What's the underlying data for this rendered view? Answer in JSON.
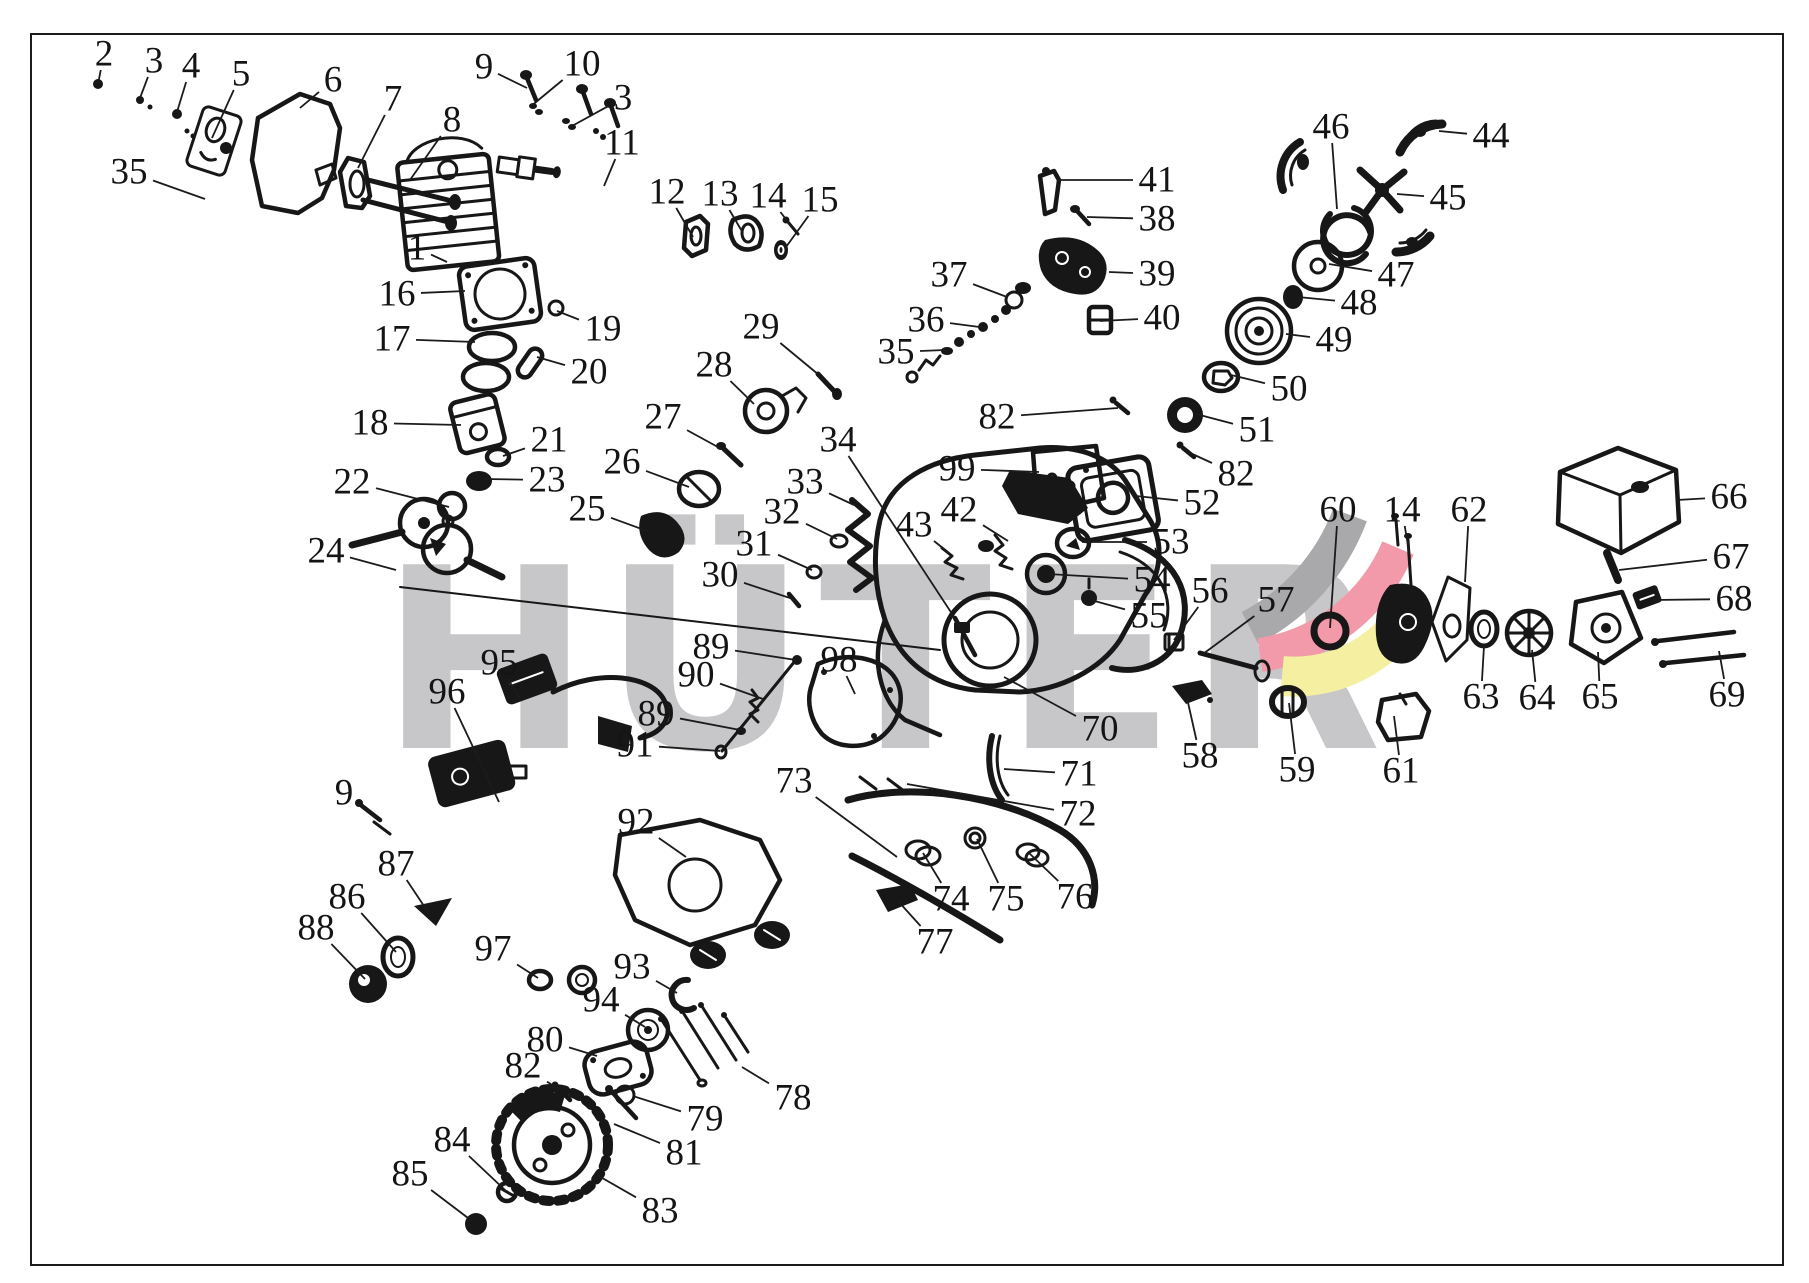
{
  "diagram": {
    "watermark_text": "HÜTER",
    "watermark_color": "#c7c7c9",
    "background": "#ffffff",
    "line_color": "#1b1b1b",
    "label_color": "#141414",
    "logo": {
      "gray": "#a9a9ab",
      "red": "#f29aaa",
      "yellow": "#f5efa2"
    },
    "labels": [
      {
        "n": "2",
        "x": 104,
        "y": 54,
        "tx": 98,
        "ty": 84
      },
      {
        "n": "3",
        "x": 154,
        "y": 61,
        "tx": 140,
        "ty": 98
      },
      {
        "n": "4",
        "x": 191,
        "y": 66,
        "tx": 177,
        "ty": 112
      },
      {
        "n": "5",
        "x": 241,
        "y": 74,
        "tx": 212,
        "ty": 138
      },
      {
        "n": "6",
        "x": 333,
        "y": 80,
        "tx": 300,
        "ty": 108
      },
      {
        "n": "7",
        "x": 393,
        "y": 99,
        "tx": 358,
        "ty": 168
      },
      {
        "n": "8",
        "x": 452,
        "y": 120,
        "tx": 410,
        "ty": 180
      },
      {
        "n": "9",
        "x": 484,
        "y": 67,
        "tx": 527,
        "ty": 88
      },
      {
        "n": "10",
        "x": 582,
        "y": 64,
        "tx": 530,
        "ty": 107
      },
      {
        "n": "3",
        "x": 623,
        "y": 98,
        "tx": 572,
        "ty": 126
      },
      {
        "n": "11",
        "x": 622,
        "y": 143,
        "tx": 604,
        "ty": 186
      },
      {
        "n": "12",
        "x": 667,
        "y": 192,
        "tx": 693,
        "ty": 237
      },
      {
        "n": "13",
        "x": 720,
        "y": 194,
        "tx": 743,
        "ty": 233
      },
      {
        "n": "14",
        "x": 768,
        "y": 196,
        "tx": 792,
        "ty": 227
      },
      {
        "n": "15",
        "x": 820,
        "y": 200,
        "tx": 786,
        "ty": 247
      },
      {
        "n": "1",
        "x": 417,
        "y": 248,
        "tx": 447,
        "ty": 262
      },
      {
        "n": "16",
        "x": 397,
        "y": 294,
        "tx": 465,
        "ty": 291
      },
      {
        "n": "17",
        "x": 392,
        "y": 339,
        "tx": 475,
        "ty": 342
      },
      {
        "n": "19",
        "x": 603,
        "y": 329,
        "tx": 557,
        "ty": 311
      },
      {
        "n": "20",
        "x": 589,
        "y": 372,
        "tx": 537,
        "ty": 357
      },
      {
        "n": "18",
        "x": 370,
        "y": 423,
        "tx": 461,
        "ty": 425
      },
      {
        "n": "21",
        "x": 549,
        "y": 440,
        "tx": 503,
        "ty": 456
      },
      {
        "n": "23",
        "x": 547,
        "y": 480,
        "tx": 485,
        "ty": 479
      },
      {
        "n": "22",
        "x": 352,
        "y": 482,
        "tx": 449,
        "ty": 507
      },
      {
        "n": "24",
        "x": 326,
        "y": 551,
        "tx": 396,
        "ty": 570
      },
      {
        "n": "25",
        "x": 587,
        "y": 509,
        "tx": 647,
        "ty": 531
      },
      {
        "n": "26",
        "x": 622,
        "y": 462,
        "tx": 689,
        "ty": 487
      },
      {
        "n": "27",
        "x": 663,
        "y": 417,
        "tx": 727,
        "ty": 452
      },
      {
        "n": "28",
        "x": 714,
        "y": 365,
        "tx": 754,
        "ty": 404
      },
      {
        "n": "29",
        "x": 761,
        "y": 327,
        "tx": 819,
        "ty": 375
      },
      {
        "n": "34",
        "x": 838,
        "y": 440,
        "tx": 960,
        "ty": 626
      },
      {
        "n": "33",
        "x": 805,
        "y": 482,
        "tx": 854,
        "ty": 505
      },
      {
        "n": "32",
        "x": 782,
        "y": 512,
        "tx": 837,
        "ty": 539
      },
      {
        "n": "31",
        "x": 754,
        "y": 544,
        "tx": 812,
        "ty": 570
      },
      {
        "n": "30",
        "x": 720,
        "y": 575,
        "tx": 793,
        "ty": 599
      },
      {
        "n": "35",
        "x": 129,
        "y": 172,
        "tx": 205,
        "ty": 199
      },
      {
        "n": "35",
        "x": 896,
        "y": 352,
        "tx": 945,
        "ty": 350
      },
      {
        "n": "36",
        "x": 926,
        "y": 320,
        "tx": 987,
        "ty": 328
      },
      {
        "n": "37",
        "x": 949,
        "y": 275,
        "tx": 1007,
        "ty": 297
      },
      {
        "n": "41",
        "x": 1157,
        "y": 180,
        "tx": 1057,
        "ty": 180
      },
      {
        "n": "38",
        "x": 1157,
        "y": 219,
        "tx": 1087,
        "ty": 217
      },
      {
        "n": "39",
        "x": 1157,
        "y": 274,
        "tx": 1109,
        "ty": 272
      },
      {
        "n": "40",
        "x": 1162,
        "y": 318,
        "tx": 1100,
        "ty": 321
      },
      {
        "n": "46",
        "x": 1331,
        "y": 127,
        "tx": 1337,
        "ty": 209
      },
      {
        "n": "44",
        "x": 1491,
        "y": 136,
        "tx": 1439,
        "ty": 131
      },
      {
        "n": "45",
        "x": 1448,
        "y": 198,
        "tx": 1397,
        "ty": 194
      },
      {
        "n": "47",
        "x": 1396,
        "y": 275,
        "tx": 1329,
        "ty": 264
      },
      {
        "n": "48",
        "x": 1359,
        "y": 303,
        "tx": 1298,
        "ty": 297
      },
      {
        "n": "49",
        "x": 1334,
        "y": 340,
        "tx": 1286,
        "ty": 334
      },
      {
        "n": "50",
        "x": 1289,
        "y": 389,
        "tx": 1231,
        "ty": 375
      },
      {
        "n": "51",
        "x": 1257,
        "y": 430,
        "tx": 1196,
        "ty": 414
      },
      {
        "n": "82",
        "x": 1236,
        "y": 474,
        "tx": 1188,
        "ty": 452
      },
      {
        "n": "52",
        "x": 1202,
        "y": 503,
        "tx": 1136,
        "ty": 496
      },
      {
        "n": "53",
        "x": 1171,
        "y": 542,
        "tx": 1082,
        "ty": 542
      },
      {
        "n": "54",
        "x": 1152,
        "y": 580,
        "tx": 1048,
        "ty": 574
      },
      {
        "n": "55",
        "x": 1149,
        "y": 616,
        "tx": 1091,
        "ty": 600
      },
      {
        "n": "56",
        "x": 1210,
        "y": 591,
        "tx": 1174,
        "ty": 640
      },
      {
        "n": "57",
        "x": 1276,
        "y": 600,
        "tx": 1203,
        "ty": 654
      },
      {
        "n": "60",
        "x": 1338,
        "y": 510,
        "tx": 1330,
        "ty": 628
      },
      {
        "n": "14",
        "x": 1402,
        "y": 510,
        "tx": 1410,
        "ty": 557
      },
      {
        "n": "62",
        "x": 1469,
        "y": 510,
        "tx": 1465,
        "ty": 582
      },
      {
        "n": "66",
        "x": 1729,
        "y": 497,
        "tx": 1677,
        "ty": 500
      },
      {
        "n": "67",
        "x": 1731,
        "y": 557,
        "tx": 1619,
        "ty": 570
      },
      {
        "n": "68",
        "x": 1734,
        "y": 599,
        "tx": 1653,
        "ty": 600
      },
      {
        "n": "69",
        "x": 1727,
        "y": 695,
        "tx": 1719,
        "ty": 651
      },
      {
        "n": "63",
        "x": 1481,
        "y": 697,
        "tx": 1484,
        "ty": 646
      },
      {
        "n": "64",
        "x": 1537,
        "y": 698,
        "tx": 1532,
        "ty": 650
      },
      {
        "n": "65",
        "x": 1600,
        "y": 697,
        "tx": 1598,
        "ty": 652
      },
      {
        "n": "61",
        "x": 1401,
        "y": 771,
        "tx": 1394,
        "ty": 716
      },
      {
        "n": "58",
        "x": 1200,
        "y": 756,
        "tx": 1187,
        "ty": 698
      },
      {
        "n": "59",
        "x": 1297,
        "y": 770,
        "tx": 1289,
        "ty": 703
      },
      {
        "n": "70",
        "x": 1100,
        "y": 729,
        "tx": 1004,
        "ty": 677
      },
      {
        "n": "71",
        "x": 1079,
        "y": 774,
        "tx": 1004,
        "ty": 769
      },
      {
        "n": "72",
        "x": 1078,
        "y": 814,
        "tx": 907,
        "ty": 784
      },
      {
        "n": "73",
        "x": 794,
        "y": 781,
        "tx": 897,
        "ty": 857
      },
      {
        "n": "74",
        "x": 951,
        "y": 899,
        "tx": 923,
        "ty": 853
      },
      {
        "n": "75",
        "x": 1006,
        "y": 899,
        "tx": 977,
        "ty": 839
      },
      {
        "n": "76",
        "x": 1075,
        "y": 897,
        "tx": 1029,
        "ty": 853
      },
      {
        "n": "77",
        "x": 935,
        "y": 942,
        "tx": 898,
        "ty": 901
      },
      {
        "n": "89",
        "x": 711,
        "y": 647,
        "tx": 796,
        "ty": 660
      },
      {
        "n": "90",
        "x": 696,
        "y": 675,
        "tx": 763,
        "ty": 699
      },
      {
        "n": "89",
        "x": 656,
        "y": 714,
        "tx": 740,
        "ty": 730
      },
      {
        "n": "91",
        "x": 635,
        "y": 745,
        "tx": 720,
        "ty": 751
      },
      {
        "n": "98",
        "x": 839,
        "y": 660,
        "tx": 855,
        "ty": 694
      },
      {
        "n": "95",
        "x": 499,
        "y": 663,
        "tx": 519,
        "ty": 698
      },
      {
        "n": "96",
        "x": 447,
        "y": 692,
        "tx": 499,
        "ty": 802
      },
      {
        "n": "92",
        "x": 636,
        "y": 822,
        "tx": 686,
        "ty": 857
      },
      {
        "n": "9",
        "x": 344,
        "y": 793,
        "tx": 376,
        "ty": 817
      },
      {
        "n": "87",
        "x": 396,
        "y": 864,
        "tx": 428,
        "ty": 912
      },
      {
        "n": "86",
        "x": 347,
        "y": 897,
        "tx": 396,
        "ty": 952
      },
      {
        "n": "88",
        "x": 316,
        "y": 928,
        "tx": 365,
        "ty": 979
      },
      {
        "n": "97",
        "x": 493,
        "y": 949,
        "tx": 538,
        "ty": 978
      },
      {
        "n": "93",
        "x": 632,
        "y": 967,
        "tx": 677,
        "ty": 993
      },
      {
        "n": "94",
        "x": 601,
        "y": 1000,
        "tx": 645,
        "ty": 1027
      },
      {
        "n": "80",
        "x": 545,
        "y": 1040,
        "tx": 597,
        "ty": 1056
      },
      {
        "n": "82",
        "x": 523,
        "y": 1066,
        "tx": 560,
        "ty": 1090
      },
      {
        "n": "78",
        "x": 793,
        "y": 1098,
        "tx": 742,
        "ty": 1067
      },
      {
        "n": "79",
        "x": 705,
        "y": 1119,
        "tx": 633,
        "ty": 1096
      },
      {
        "n": "81",
        "x": 684,
        "y": 1153,
        "tx": 614,
        "ty": 1124
      },
      {
        "n": "84",
        "x": 452,
        "y": 1140,
        "tx": 505,
        "ty": 1190
      },
      {
        "n": "85",
        "x": 410,
        "y": 1174,
        "tx": 472,
        "ty": 1221
      },
      {
        "n": "83",
        "x": 660,
        "y": 1211,
        "tx": 597,
        "ty": 1175
      },
      {
        "n": "99",
        "x": 957,
        "y": 469,
        "tx": 1039,
        "ty": 472
      },
      {
        "n": "82",
        "x": 997,
        "y": 417,
        "tx": 1118,
        "ty": 408
      },
      {
        "n": "42",
        "x": 959,
        "y": 510,
        "tx": 1008,
        "ty": 541
      },
      {
        "n": "43",
        "x": 914,
        "y": 525,
        "tx": 949,
        "ty": 553
      }
    ]
  }
}
